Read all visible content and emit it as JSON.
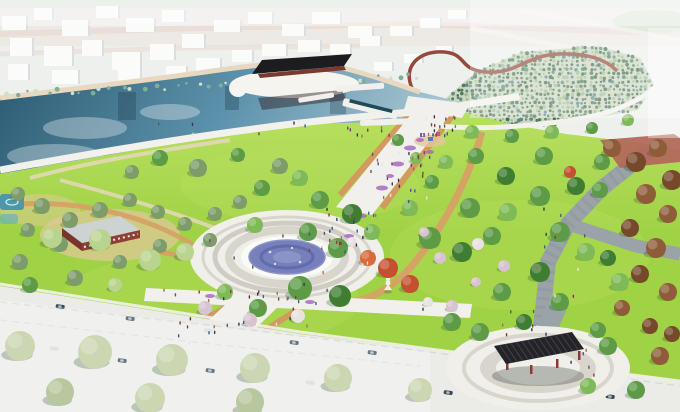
{
  "palette": {
    "haze": "#eef0ed",
    "sky_strip": "#dfe8df",
    "terrain": "#ece8e3",
    "terrain_pink": "#e5d2c9",
    "terrain_green": "#cfe0c8",
    "city_white": "#fbfbfa",
    "city_shadow": "#d9dee1",
    "water_deep": "#2b5a70",
    "water_mid": "#5e93ad",
    "water_pale": "#a9c6d2",
    "sand": "#e8d8c0",
    "shore_white": "#f3f1ec",
    "shore_teal": "#7fae9b",
    "lawn": "#a0d246",
    "lawn_light": "#b8e060",
    "field_base": "#cdd6c0",
    "field_dot_dark": "#456f4e",
    "field_dot_mid": "#4e7d5c",
    "field_dot_light": "#9fbe8f",
    "field_dot_teal": "#5a8d85",
    "walkway_red": "#96493b",
    "promenade": "#f1f0ec",
    "path_tan": "#d29a5f",
    "dirt": "#d7a165",
    "sand_blob": "#e3c79c",
    "plaza_white": "#f0efe9",
    "plaza_ring": "#d8d5cd",
    "plaza_ring2": "#cfccc4",
    "fountain_white": "#fafaf6",
    "fountain_blue": "#7780ba",
    "fountain_blue_dark": "#5a63a8",
    "fountain_blue_light": "#8c93c8",
    "paver_gray": "#9aa3a7",
    "paver_dark": "#7f898d",
    "brick": "#b2695b",
    "road": "#ebebe8",
    "road_line": "#d8d8d4",
    "pergola_roof": "#242428",
    "pergola_slat": "#46464e",
    "pergola_post": "#8a3a32",
    "pavilion_roof": "#1c1c21",
    "pavilion_base": "#7a3a30",
    "pavilion_reflection": "rgba(45,25,28,0.45)",
    "island_white": "#f6f4ef",
    "pool_dark": "#1f4a56",
    "canopy_green": "#5d9b46",
    "canopy_dark": "#3f7d33",
    "canopy_light": "#7fba58",
    "pine_olive": "#7d9c6a",
    "willow": "#b9d48e",
    "maple_red": "#c4502f",
    "maple_orange": "#d96b3a",
    "autumn_brown": "#8f5c39",
    "autumn_dark": "#76492b",
    "blossom": "#d8c3d0",
    "blossom_white": "#e9e2e4",
    "pale_tree": "#ccd6b2",
    "pale_tree_dark": "#b8c79e",
    "tree_shadow": "rgba(30,80,30,0.26)",
    "flower_purple": "#a86bc0",
    "teal_feature": "#4d98a8",
    "teal_feature_light": "#6ab0be",
    "car_dark": "#3d4750",
    "car_light": "#d8dadc",
    "reflection_dark": "rgba(35,65,82,0.4)",
    "cloud_white": "rgba(255,255,255,0.32)",
    "lantern_white": "#f0efe8",
    "playground_purple": "#7a5fae",
    "playground_blue": "#4a7fc0",
    "playground_pink": "#c05a8a",
    "glass_roof": "#ccd3d6",
    "brick_wall": "#8e3f37",
    "brick_wall_dark": "#7a342c"
  },
  "scene": {
    "city": {
      "buildings": [
        [
          2,
          16,
          26,
          14
        ],
        [
          34,
          8,
          20,
          12
        ],
        [
          62,
          20,
          28,
          16
        ],
        [
          96,
          6,
          24,
          12
        ],
        [
          126,
          18,
          30,
          14
        ],
        [
          162,
          10,
          24,
          12
        ],
        [
          10,
          38,
          24,
          18
        ],
        [
          44,
          46,
          30,
          20
        ],
        [
          82,
          40,
          22,
          16
        ],
        [
          112,
          52,
          30,
          18
        ],
        [
          150,
          44,
          26,
          16
        ],
        [
          182,
          34,
          24,
          14
        ],
        [
          214,
          20,
          28,
          12
        ],
        [
          248,
          12,
          26,
          12
        ],
        [
          282,
          24,
          24,
          12
        ],
        [
          312,
          12,
          30,
          12
        ],
        [
          348,
          26,
          26,
          12
        ],
        [
          196,
          58,
          26,
          14
        ],
        [
          232,
          50,
          22,
          12
        ],
        [
          262,
          44,
          26,
          12
        ],
        [
          298,
          40,
          24,
          12
        ],
        [
          330,
          44,
          22,
          10
        ],
        [
          360,
          36,
          22,
          10
        ],
        [
          390,
          26,
          24,
          10
        ],
        [
          420,
          18,
          22,
          10
        ],
        [
          448,
          10,
          20,
          9
        ],
        [
          8,
          64,
          22,
          16
        ],
        [
          52,
          70,
          28,
          14
        ],
        [
          118,
          70,
          24,
          11
        ],
        [
          166,
          66,
          22,
          12
        ],
        [
          374,
          62,
          20,
          9
        ],
        [
          404,
          54,
          20,
          9
        ],
        [
          436,
          46,
          18,
          8
        ]
      ]
    },
    "shore_veg": {
      "from": [
        6,
        94
      ],
      "to": [
        420,
        76
      ],
      "n": 40
    },
    "field": {
      "polygon": [
        [
          438,
          126
        ],
        [
          446,
          98
        ],
        [
          476,
          72
        ],
        [
          522,
          52
        ],
        [
          598,
          46
        ],
        [
          640,
          58
        ],
        [
          654,
          84
        ],
        [
          638,
          110
        ],
        [
          560,
          124
        ],
        [
          488,
          132
        ]
      ],
      "dot_colors": [
        "field_dot_dark",
        "field_dot_mid",
        "field_dot_teal",
        "field_dot_light"
      ],
      "grid": {
        "x0": 430,
        "x1": 662,
        "y0": 44,
        "y1": 136,
        "step_x": 4.6,
        "step_y": 4.2
      }
    },
    "piers": [
      [
        336,
        86,
        48,
        6,
        -4
      ],
      [
        298,
        98,
        36,
        5,
        -9
      ],
      [
        344,
        98,
        56,
        8,
        14
      ],
      [
        398,
        110,
        66,
        7,
        -5
      ],
      [
        360,
        120,
        52,
        6,
        -2
      ],
      [
        436,
        106,
        84,
        7,
        -9
      ]
    ],
    "pergola": {
      "corners": [
        [
          494,
          346
        ],
        [
          572,
          332
        ],
        [
          584,
          349
        ],
        [
          506,
          364
        ]
      ],
      "slats": 14,
      "posts": [
        [
          506,
          361
        ],
        [
          530,
          365
        ],
        [
          556,
          359
        ],
        [
          578,
          351
        ]
      ]
    },
    "trees": [
      [
        160,
        158,
        8,
        "canopy_green"
      ],
      [
        198,
        168,
        9,
        "pine_olive"
      ],
      [
        238,
        155,
        7,
        "canopy_green"
      ],
      [
        280,
        166,
        8,
        "pine_olive"
      ],
      [
        132,
        172,
        7,
        "pine_olive"
      ],
      [
        18,
        194,
        7,
        "pine_olive"
      ],
      [
        42,
        206,
        8,
        "pine_olive"
      ],
      [
        70,
        220,
        8,
        "pine_olive"
      ],
      [
        100,
        210,
        8,
        "pine_olive"
      ],
      [
        130,
        200,
        7,
        "pine_olive"
      ],
      [
        158,
        212,
        7,
        "pine_olive"
      ],
      [
        185,
        224,
        7,
        "pine_olive"
      ],
      [
        215,
        214,
        7,
        "pine_olive"
      ],
      [
        240,
        202,
        7,
        "pine_olive"
      ],
      [
        28,
        230,
        7,
        "pine_olive"
      ],
      [
        60,
        244,
        8,
        "pine_olive"
      ],
      [
        20,
        262,
        8,
        "pine_olive"
      ],
      [
        120,
        262,
        7,
        "pine_olive"
      ],
      [
        160,
        246,
        7,
        "pine_olive"
      ],
      [
        210,
        240,
        7,
        "pine_olive"
      ],
      [
        52,
        238,
        10,
        "willow"
      ],
      [
        100,
        240,
        11,
        "willow"
      ],
      [
        150,
        260,
        11,
        "willow"
      ],
      [
        185,
        252,
        9,
        "willow"
      ],
      [
        30,
        285,
        8,
        "canopy_green"
      ],
      [
        75,
        278,
        8,
        "pine_olive"
      ],
      [
        115,
        285,
        7,
        "willow"
      ],
      [
        262,
        188,
        8,
        "canopy_green"
      ],
      [
        300,
        178,
        8,
        "canopy_light"
      ],
      [
        320,
        200,
        9,
        "canopy_green"
      ],
      [
        352,
        214,
        10,
        "canopy_dark"
      ],
      [
        308,
        232,
        9,
        "canopy_green"
      ],
      [
        338,
        248,
        10,
        "canopy_green"
      ],
      [
        372,
        232,
        8,
        "canopy_light"
      ],
      [
        255,
        225,
        8,
        "canopy_light"
      ],
      [
        300,
        288,
        12,
        "canopy_green"
      ],
      [
        340,
        296,
        11,
        "canopy_dark"
      ],
      [
        258,
        308,
        9,
        "canopy_green"
      ],
      [
        225,
        292,
        8,
        "canopy_light"
      ],
      [
        205,
        308,
        7,
        "blossom"
      ],
      [
        250,
        320,
        7,
        "blossom"
      ],
      [
        298,
        316,
        7,
        "blossom_white"
      ],
      [
        430,
        238,
        11,
        "canopy_green"
      ],
      [
        462,
        252,
        10,
        "canopy_dark"
      ],
      [
        492,
        236,
        9,
        "canopy_green"
      ],
      [
        470,
        208,
        10,
        "canopy_green"
      ],
      [
        508,
        212,
        9,
        "canopy_light"
      ],
      [
        540,
        196,
        10,
        "canopy_green"
      ],
      [
        506,
        176,
        9,
        "canopy_dark"
      ],
      [
        476,
        156,
        8,
        "canopy_green"
      ],
      [
        446,
        162,
        7,
        "canopy_light"
      ],
      [
        544,
        156,
        9,
        "canopy_green"
      ],
      [
        576,
        186,
        9,
        "canopy_dark"
      ],
      [
        602,
        162,
        8,
        "canopy_green"
      ],
      [
        560,
        232,
        10,
        "canopy_green"
      ],
      [
        586,
        252,
        9,
        "canopy_light"
      ],
      [
        540,
        272,
        10,
        "canopy_dark"
      ],
      [
        502,
        292,
        9,
        "canopy_green"
      ],
      [
        560,
        302,
        9,
        "canopy_green"
      ],
      [
        620,
        282,
        9,
        "canopy_light"
      ],
      [
        480,
        332,
        9,
        "canopy_green"
      ],
      [
        524,
        322,
        8,
        "canopy_dark"
      ],
      [
        410,
        208,
        8,
        "canopy_light"
      ],
      [
        432,
        182,
        7,
        "canopy_green"
      ],
      [
        368,
        258,
        8,
        "maple_orange"
      ],
      [
        388,
        268,
        10,
        "maple_red"
      ],
      [
        410,
        284,
        9,
        "maple_red"
      ],
      [
        570,
        172,
        6,
        "maple_red"
      ],
      [
        440,
        258,
        6,
        "blossom"
      ],
      [
        478,
        244,
        6,
        "blossom_white"
      ],
      [
        504,
        266,
        6,
        "blossom"
      ],
      [
        352,
        242,
        5,
        "blossom_white"
      ],
      [
        424,
        232,
        5,
        "blossom"
      ],
      [
        452,
        306,
        6,
        "blossom"
      ],
      [
        428,
        302,
        5,
        "blossom_white"
      ],
      [
        476,
        282,
        5,
        "blossom"
      ],
      [
        612,
        148,
        9,
        "autumn_brown"
      ],
      [
        636,
        162,
        10,
        "autumn_dark"
      ],
      [
        658,
        148,
        9,
        "autumn_brown"
      ],
      [
        672,
        180,
        10,
        "autumn_dark"
      ],
      [
        646,
        194,
        10,
        "autumn_brown"
      ],
      [
        668,
        214,
        9,
        "autumn_brown"
      ],
      [
        630,
        228,
        9,
        "autumn_dark"
      ],
      [
        656,
        248,
        10,
        "autumn_brown"
      ],
      [
        640,
        274,
        9,
        "autumn_dark"
      ],
      [
        668,
        292,
        9,
        "autumn_brown"
      ],
      [
        622,
        308,
        8,
        "autumn_brown"
      ],
      [
        650,
        326,
        8,
        "autumn_dark"
      ],
      [
        600,
        190,
        8,
        "canopy_green"
      ],
      [
        608,
        258,
        8,
        "canopy_dark"
      ],
      [
        598,
        330,
        8,
        "canopy_green"
      ],
      [
        452,
        322,
        9,
        "canopy_green"
      ],
      [
        608,
        346,
        9,
        "canopy_green"
      ],
      [
        660,
        356,
        9,
        "autumn_brown"
      ],
      [
        672,
        334,
        8,
        "autumn_dark"
      ],
      [
        588,
        386,
        8,
        "canopy_light"
      ],
      [
        636,
        390,
        9,
        "canopy_green"
      ],
      [
        472,
        132,
        7,
        "canopy_light"
      ],
      [
        512,
        136,
        7,
        "canopy_green"
      ],
      [
        552,
        132,
        7,
        "canopy_light"
      ],
      [
        592,
        128,
        6,
        "canopy_green"
      ],
      [
        628,
        120,
        6,
        "canopy_light"
      ],
      [
        398,
        140,
        6,
        "canopy_green"
      ],
      [
        416,
        158,
        6,
        "canopy_light"
      ],
      [
        20,
        346,
        15,
        "pale_tree"
      ],
      [
        95,
        352,
        17,
        "pale_tree"
      ],
      [
        172,
        360,
        16,
        "pale_tree"
      ],
      [
        255,
        368,
        15,
        "pale_tree"
      ],
      [
        338,
        378,
        14,
        "pale_tree"
      ],
      [
        60,
        392,
        14,
        "pale_tree_dark"
      ],
      [
        150,
        398,
        15,
        "pale_tree"
      ],
      [
        250,
        402,
        14,
        "pale_tree_dark"
      ],
      [
        420,
        390,
        12,
        "pale_tree"
      ]
    ],
    "flowers": [
      [
        410,
        148,
        6,
        2.5
      ],
      [
        398,
        164,
        6,
        2.5
      ],
      [
        382,
        188,
        6,
        2.5
      ],
      [
        362,
        216,
        5,
        2
      ],
      [
        349,
        236,
        5,
        2
      ],
      [
        420,
        140,
        4,
        2
      ],
      [
        390,
        176,
        4,
        2
      ],
      [
        430,
        152,
        4,
        2
      ],
      [
        210,
        296,
        5,
        2
      ],
      [
        310,
        302,
        5,
        2
      ]
    ],
    "people_zones": [
      [
        418,
        108,
        42,
        26,
        20
      ],
      [
        370,
        150,
        60,
        50,
        30
      ],
      [
        320,
        205,
        55,
        45,
        20
      ],
      [
        205,
        225,
        165,
        75,
        20
      ],
      [
        235,
        290,
        80,
        40,
        12
      ],
      [
        175,
        315,
        55,
        35,
        10
      ],
      [
        150,
        115,
        240,
        20,
        16
      ],
      [
        528,
        205,
        60,
        95,
        10
      ],
      [
        500,
        300,
        50,
        36,
        8
      ],
      [
        160,
        288,
        300,
        22,
        14
      ],
      [
        540,
        348,
        60,
        28,
        6
      ]
    ],
    "people_colors": [
      "#323c4e",
      "#8a3a3a",
      "#e6e6e6",
      "#3e5e80",
      "#5a5a5a",
      "#a0725a"
    ],
    "cars": [
      [
        56,
        304
      ],
      [
        126,
        316
      ],
      [
        204,
        328
      ],
      [
        290,
        340
      ],
      [
        368,
        350
      ],
      [
        50,
        346
      ],
      [
        118,
        358
      ],
      [
        206,
        368
      ],
      [
        306,
        380
      ],
      [
        444,
        390
      ],
      [
        606,
        394
      ]
    ]
  }
}
